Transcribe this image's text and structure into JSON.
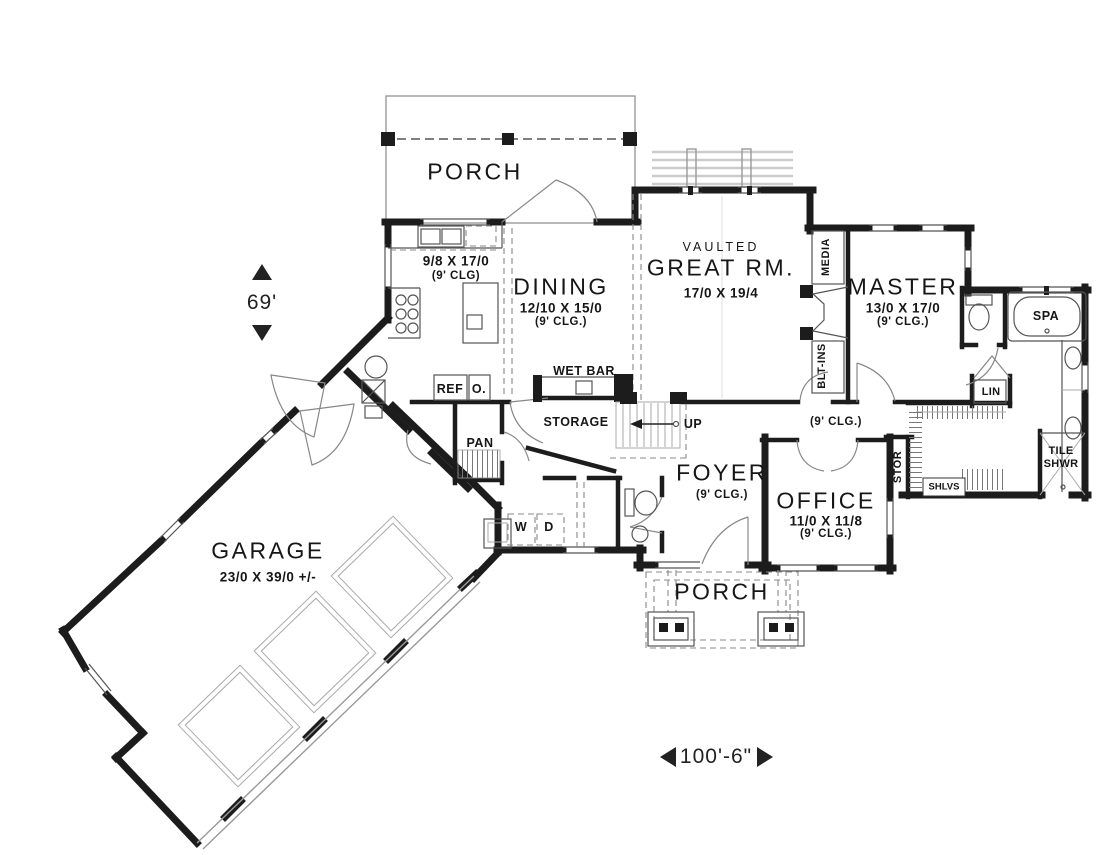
{
  "plan": {
    "rooms": {
      "porch_top": {
        "name": "PORCH"
      },
      "kitchen": {
        "dims": "9/8 X 17/0",
        "ceiling": "(9' CLG)"
      },
      "dining": {
        "name": "DINING",
        "dims": "12/10 X 15/0",
        "ceiling": "(9' CLG.)"
      },
      "great_room": {
        "prefix": "VAULTED",
        "name": "GREAT RM.",
        "dims": "17/0 X 19/4"
      },
      "master": {
        "name": "MASTER",
        "dims": "13/0 X 17/0",
        "ceiling": "(9' CLG.)"
      },
      "hall": {
        "ceiling": "(9' CLG.)"
      },
      "foyer": {
        "name": "FOYER",
        "ceiling": "(9' CLG.)"
      },
      "office": {
        "name": "OFFICE",
        "dims": "11/0 X 11/8",
        "ceiling": "(9' CLG.)"
      },
      "storage": {
        "name": "STORAGE"
      },
      "garage": {
        "name": "GARAGE",
        "dims": "23/0 X 39/0 +/-"
      },
      "porch_bottom": {
        "name": "PORCH"
      }
    },
    "fixtures": {
      "wet_bar": "WET BAR",
      "refrigerator": "REF",
      "oven": "O.",
      "pantry": "PAN",
      "stairs_up": "UP",
      "washer": "W",
      "dryer": "D",
      "spa": "SPA",
      "linen": "LIN",
      "tile_shower_line1": "TILE",
      "tile_shower_line2": "SHWR",
      "shelves": "SHLVS",
      "storage_closet": "STOR",
      "media": "MEDIA",
      "built_ins": "BLT-INS"
    },
    "dimensions": {
      "vertical": "69'",
      "horizontal": "100'-6\""
    },
    "colors": {
      "wall": "#1c1c1c",
      "line": "#555555",
      "light_line": "#aaaaaa",
      "text": "#161616",
      "background": "#ffffff"
    }
  }
}
